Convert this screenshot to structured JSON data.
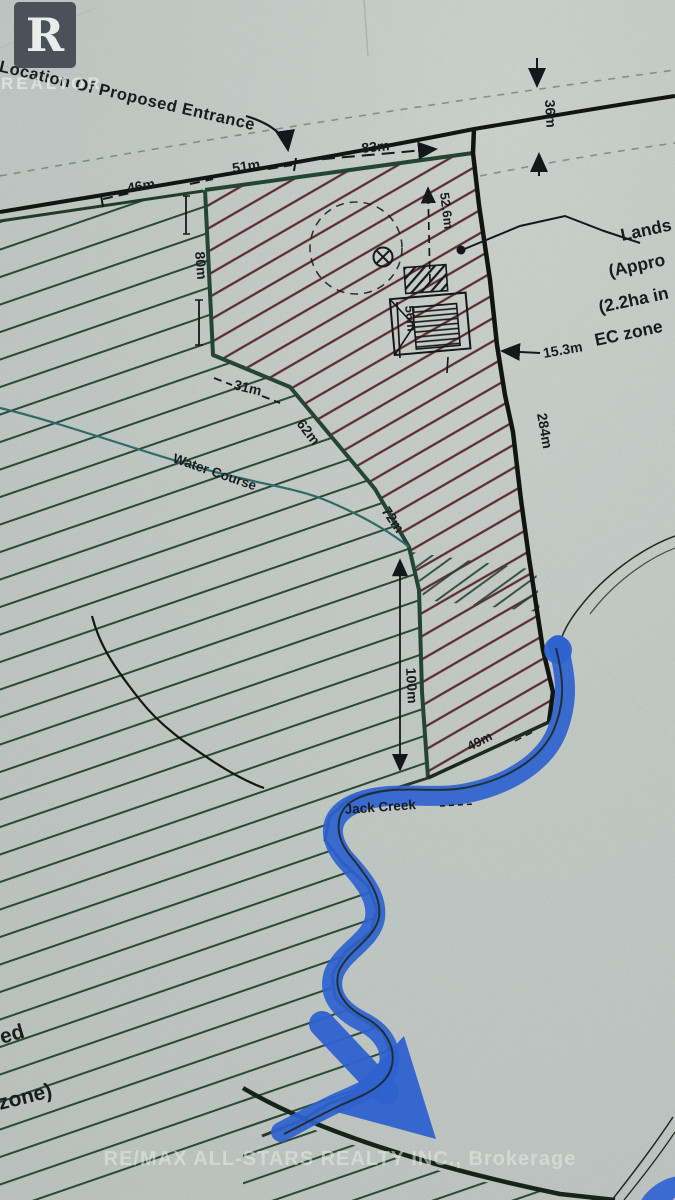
{
  "watermarks": {
    "logo_letter": "R",
    "realtor_text": "REALTOR",
    "footer_text": "RE/MAX ALL-STARS REALTY INC., Brokerage"
  },
  "annotations": {
    "entrance_label": "e Location Of Proposed Entrance",
    "water_course_label": "Water Course",
    "jack_creek_label": "Jack Creek",
    "lands_note_lines": [
      "Lands",
      "(Appro",
      "(2.2ha in",
      "EC zone"
    ],
    "left_edge_partial_1": "ed",
    "left_edge_partial_2": "zone)"
  },
  "measurements": {
    "road_seg_46": "46m",
    "road_seg_51": "51m",
    "road_seg_83": "83m",
    "road_allowance": "36m",
    "west_80": "80m",
    "jog_31": "31m",
    "diag_62": "62m",
    "diag_72": "72m",
    "south_100": "100m",
    "depth_52_6": "52.6m",
    "building_56": "56m",
    "east_15_3": "15.3m",
    "east_284": "284m",
    "bottom_49": "49m"
  },
  "colors": {
    "paper": "#cbd5d0",
    "hatch_green": "#2a4a37",
    "hatch_red": "#5c2b33",
    "boundary_black": "#15181a",
    "boundary_green": "#234534",
    "creek_blue": "#2e62cf",
    "water_teal": "#2e6a68",
    "watermark": "#e8eeea"
  }
}
